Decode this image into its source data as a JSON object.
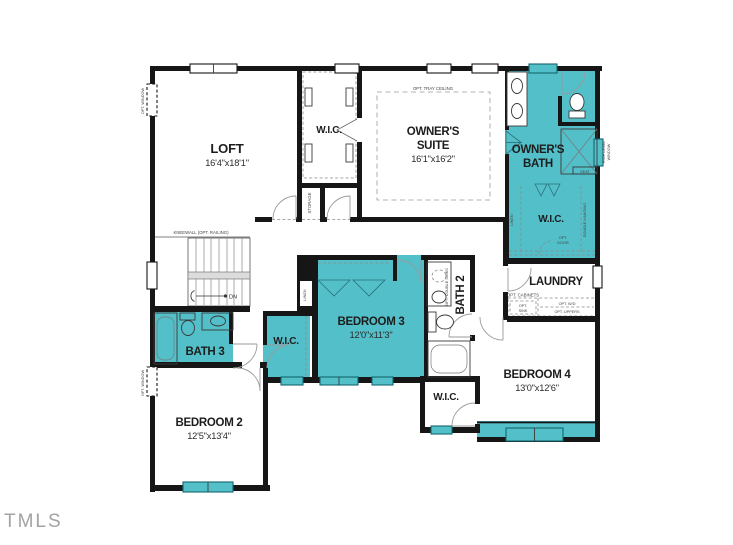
{
  "plan": {
    "watermark": "TMLS",
    "rooms": {
      "loft": {
        "name": "LOFT",
        "dims": "16'4\"x18'1\""
      },
      "wic_hall": {
        "name": "W.I.C."
      },
      "owners_suite": {
        "name1": "OWNER'S",
        "name2": "SUITE",
        "dims": "16'1\"x16'2\""
      },
      "owners_bath": {
        "name1": "OWNER'S",
        "name2": "BATH"
      },
      "owners_wic": {
        "name": "W.I.C."
      },
      "laundry": {
        "name": "LAUNDRY"
      },
      "bath2": {
        "name": "BATH 2"
      },
      "bedroom3": {
        "name": "BEDROOM 3",
        "dims": "12'0\"x11'3\""
      },
      "wic_bed3": {
        "name": "W.I.C."
      },
      "bath3": {
        "name": "BATH 3"
      },
      "bedroom2": {
        "name": "BEDROOM 2",
        "dims": "12'5\"x13'4\""
      },
      "wic_bed4": {
        "name": "W.I.C."
      },
      "bedroom4": {
        "name": "BEDROOM 4",
        "dims": "13'0\"x12'6\""
      }
    },
    "annotations": {
      "kneewall": "KNEEWALL (OPT. RAILING)",
      "tray_ceiling": "OPT. TRAY CEILING",
      "opt_window": "OPT. WINDOW",
      "storage": "STORAGE",
      "linen": "LINEN",
      "double_hanging": "DOUBLE HANGING",
      "high_level_1": "HIGH LEVEL",
      "high_level_2": "WINDOW",
      "seat": "SEAT",
      "opt_door_1": "OPT.",
      "opt_door_2": "DOOR",
      "opt_cabinets": "OPT. CABINETS",
      "opt_sink_1": "OPT.",
      "opt_sink_2": "SINK",
      "opt_wd": "OPT. W/D",
      "opt_uppers": "OPT. UPPERS",
      "opt_double_sinks": "OPT. DOUBLE SINKS",
      "down": "DN"
    },
    "colors": {
      "highlight": "#53bfc9",
      "wall": "#161616",
      "line": "#9a9a9a",
      "text": "#1d1d1d",
      "watermark": "#a3a3a3",
      "window_border": "#15666e"
    }
  }
}
